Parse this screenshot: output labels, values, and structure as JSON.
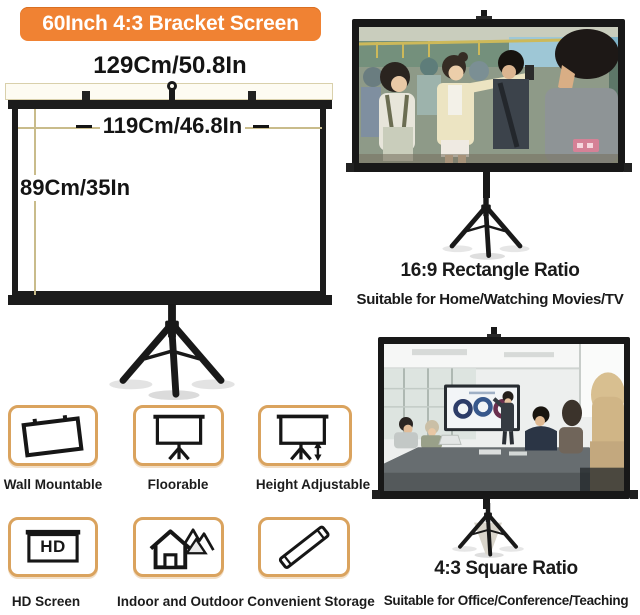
{
  "banner": {
    "label": "60Inch 4:3 Bracket Screen",
    "bg_color": "#f08233",
    "text_color": "#ffffff"
  },
  "diagram": {
    "outer_width": "129Cm/50.8In",
    "inner_width": "119Cm/46.8In",
    "height": "89Cm/35In"
  },
  "ratio_sections": {
    "rectangle": {
      "title": "16:9 Rectangle Ratio",
      "subtitle": "Suitable for Home/Watching Movies/TV"
    },
    "square": {
      "title": "4:3 Square Ratio",
      "subtitle": "Suitable for Office/Conference/Teaching"
    }
  },
  "features": [
    {
      "label": "Wall Mountable",
      "icon": "wall-mount-screen-icon"
    },
    {
      "label": "Floorable",
      "icon": "tripod-screen-icon"
    },
    {
      "label": "Height Adjustable",
      "icon": "height-adjust-screen-icon"
    },
    {
      "label": "HD Screen",
      "icon": "hd-screen-icon",
      "badge": "HD"
    },
    {
      "label": "Indoor and Outdoor",
      "icon": "house-icon"
    },
    {
      "label": "Convenient Storage",
      "icon": "storage-tube-icon"
    }
  ],
  "colors": {
    "banner_orange": "#f08233",
    "feature_border": "#daa35e",
    "measure_line": "#c9bc8b",
    "frame_black": "#1b1b1b"
  }
}
